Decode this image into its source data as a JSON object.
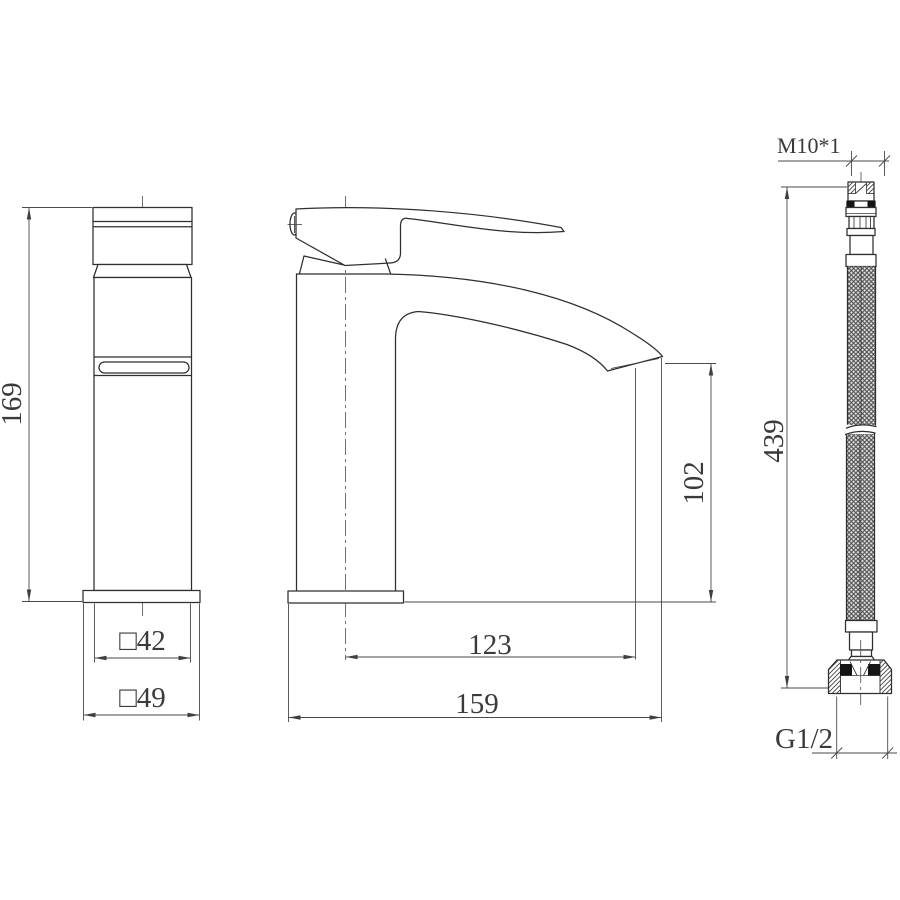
{
  "drawing": {
    "background": "#ffffff",
    "outline_color": "#2f2f2f",
    "dimension_color": "#4a4a4a",
    "text_color": "#3a3a3a",
    "braid_tone": "#e3e3e3"
  },
  "dimensions": {
    "front_height": "169",
    "front_body_width": "□42",
    "front_base_width": "□49",
    "side_spout_height": "102",
    "side_spout_reach": "123",
    "side_overall_length": "159",
    "hose_top_thread": "M10*1",
    "hose_length": "439",
    "hose_bottom_thread": "G1/2"
  }
}
